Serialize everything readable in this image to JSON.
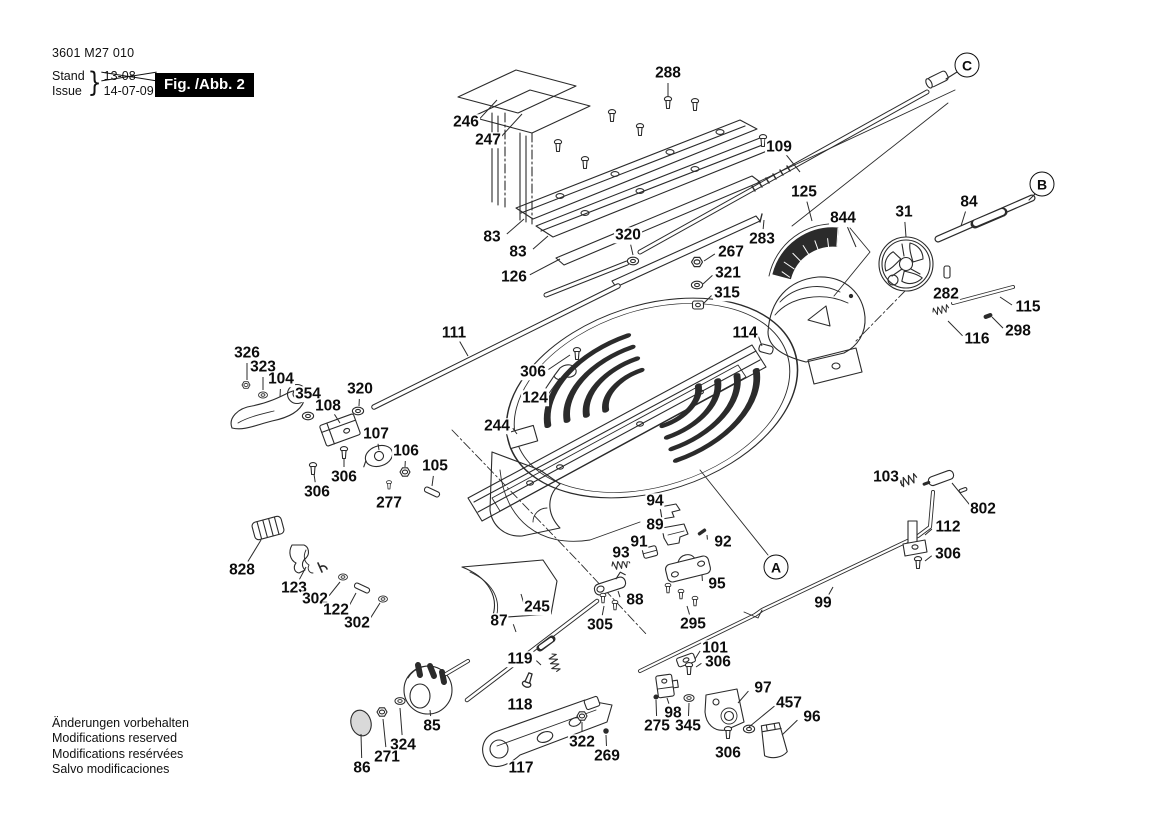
{
  "header": {
    "part_number": "3601 M27 010",
    "stand_label": "Stand",
    "issue_label": "Issue",
    "stand_value": "13-08",
    "issue_value": "14-07-09",
    "figure_label": "Fig. /Abb. 2"
  },
  "footer": {
    "notes": [
      "Änderungen vorbehalten",
      "Modifications reserved",
      "Modifications resérvées",
      "Salvo modificaciones"
    ]
  },
  "colors": {
    "ink": "#0d0d0d",
    "figbox_bg": "#000000",
    "figbox_text": "#ffffff"
  },
  "reference_bubbles": [
    {
      "label": "A",
      "x": 776,
      "y": 567
    },
    {
      "label": "B",
      "x": 1042,
      "y": 184
    },
    {
      "label": "C",
      "x": 967,
      "y": 65
    }
  ],
  "callouts": [
    {
      "label": "288",
      "x": 668,
      "y": 73,
      "tx": 668,
      "ty": 96
    },
    {
      "label": "246",
      "x": 466,
      "y": 122,
      "tx": 497,
      "ty": 100
    },
    {
      "label": "247",
      "x": 488,
      "y": 140,
      "tx": 522,
      "ty": 114
    },
    {
      "label": "109",
      "x": 779,
      "y": 147,
      "tx": 800,
      "ty": 172
    },
    {
      "label": "83",
      "x": 492,
      "y": 237,
      "tx": 524,
      "ty": 219
    },
    {
      "label": "83",
      "x": 518,
      "y": 252,
      "tx": 548,
      "ty": 236
    },
    {
      "label": "126",
      "x": 514,
      "y": 277,
      "tx": 560,
      "ty": 259
    },
    {
      "label": "320",
      "x": 628,
      "y": 235,
      "tx": 633,
      "ty": 255
    },
    {
      "label": "125",
      "x": 804,
      "y": 192,
      "tx": 812,
      "ty": 221
    },
    {
      "label": "844",
      "x": 843,
      "y": 218,
      "tx": 856,
      "ty": 247
    },
    {
      "label": "283",
      "x": 762,
      "y": 239,
      "tx": 764,
      "ty": 220
    },
    {
      "label": "267",
      "x": 731,
      "y": 252,
      "tx": 704,
      "ty": 261
    },
    {
      "label": "321",
      "x": 728,
      "y": 273,
      "tx": 703,
      "ty": 284
    },
    {
      "label": "315",
      "x": 727,
      "y": 293,
      "tx": 703,
      "ty": 304
    },
    {
      "label": "31",
      "x": 904,
      "y": 212,
      "tx": 906,
      "ty": 237
    },
    {
      "label": "84",
      "x": 969,
      "y": 202,
      "tx": 961,
      "ty": 226
    },
    {
      "label": "282",
      "x": 946,
      "y": 294,
      "tx": 947,
      "ty": 280
    },
    {
      "label": "115",
      "x": 1028,
      "y": 307,
      "tx": 1000,
      "ty": 297
    },
    {
      "label": "298",
      "x": 1018,
      "y": 331,
      "tx": 992,
      "ty": 317
    },
    {
      "label": "116",
      "x": 977,
      "y": 339,
      "tx": 948,
      "ty": 321
    },
    {
      "label": "114",
      "x": 745,
      "y": 333,
      "tx": 762,
      "ty": 346
    },
    {
      "label": "111",
      "x": 454,
      "y": 333,
      "tx": 468,
      "ty": 356
    },
    {
      "label": "326",
      "x": 247,
      "y": 353,
      "tx": 247,
      "ty": 380
    },
    {
      "label": "323",
      "x": 263,
      "y": 367,
      "tx": 263,
      "ty": 390
    },
    {
      "label": "104",
      "x": 281,
      "y": 379,
      "tx": 280,
      "ty": 397
    },
    {
      "label": "354",
      "x": 308,
      "y": 394,
      "tx": 308,
      "ty": 410
    },
    {
      "label": "108",
      "x": 328,
      "y": 406,
      "tx": 340,
      "ty": 423
    },
    {
      "label": "320",
      "x": 360,
      "y": 389,
      "tx": 359,
      "ty": 406
    },
    {
      "label": "107",
      "x": 376,
      "y": 434,
      "tx": 379,
      "ty": 450
    },
    {
      "label": "106",
      "x": 406,
      "y": 451,
      "tx": 405,
      "ty": 467
    },
    {
      "label": "105",
      "x": 435,
      "y": 466,
      "tx": 432,
      "ty": 486
    },
    {
      "label": "306",
      "x": 533,
      "y": 372,
      "tx": 570,
      "ty": 355
    },
    {
      "label": "124",
      "x": 535,
      "y": 398,
      "tx": 560,
      "ty": 378
    },
    {
      "label": "244",
      "x": 497,
      "y": 426,
      "tx": 517,
      "ty": 434
    },
    {
      "label": "306",
      "x": 344,
      "y": 477,
      "tx": 344,
      "ty": 459
    },
    {
      "label": "306",
      "x": 317,
      "y": 492,
      "tx": 314,
      "ty": 474
    },
    {
      "label": "277",
      "x": 389,
      "y": 503,
      "tx": 389,
      "ty": 490
    },
    {
      "label": "828",
      "x": 242,
      "y": 570,
      "tx": 261,
      "ty": 540
    },
    {
      "label": "123",
      "x": 294,
      "y": 588,
      "tx": 306,
      "ty": 567
    },
    {
      "label": "302",
      "x": 315,
      "y": 599,
      "tx": 340,
      "ty": 582
    },
    {
      "label": "122",
      "x": 336,
      "y": 610,
      "tx": 356,
      "ty": 593
    },
    {
      "label": "302",
      "x": 357,
      "y": 623,
      "tx": 380,
      "ty": 603
    },
    {
      "label": "87",
      "x": 499,
      "y": 621,
      "tx": 516,
      "ty": 632
    },
    {
      "label": "245",
      "x": 537,
      "y": 607,
      "tx": 521,
      "ty": 594
    },
    {
      "label": "94",
      "x": 655,
      "y": 501,
      "tx": 667,
      "ty": 510
    },
    {
      "label": "89",
      "x": 655,
      "y": 525,
      "tx": 667,
      "ty": 532
    },
    {
      "label": "91",
      "x": 639,
      "y": 542,
      "tx": 648,
      "ty": 551
    },
    {
      "label": "93",
      "x": 621,
      "y": 553,
      "tx": 624,
      "ty": 565
    },
    {
      "label": "92",
      "x": 723,
      "y": 542,
      "tx": 707,
      "ty": 535
    },
    {
      "label": "95",
      "x": 717,
      "y": 584,
      "tx": 702,
      "ty": 575
    },
    {
      "label": "88",
      "x": 635,
      "y": 600,
      "tx": 618,
      "ty": 591
    },
    {
      "label": "305",
      "x": 600,
      "y": 625,
      "tx": 604,
      "ty": 606
    },
    {
      "label": "295",
      "x": 693,
      "y": 624,
      "tx": 687,
      "ty": 606
    },
    {
      "label": "103",
      "x": 886,
      "y": 477,
      "tx": 902,
      "ty": 486
    },
    {
      "label": "802",
      "x": 983,
      "y": 509,
      "tx": 952,
      "ty": 483
    },
    {
      "label": "112",
      "x": 948,
      "y": 527,
      "tx": 925,
      "ty": 535
    },
    {
      "label": "306",
      "x": 948,
      "y": 554,
      "tx": 925,
      "ty": 561
    },
    {
      "label": "99",
      "x": 823,
      "y": 603,
      "tx": 833,
      "ty": 587
    },
    {
      "label": "101",
      "x": 715,
      "y": 648,
      "tx": 695,
      "ty": 659
    },
    {
      "label": "306",
      "x": 718,
      "y": 662,
      "tx": 696,
      "ty": 667
    },
    {
      "label": "119",
      "x": 520,
      "y": 659,
      "tx": 541,
      "ty": 665
    },
    {
      "label": "118",
      "x": 520,
      "y": 705,
      "tx": 525,
      "ty": 691
    },
    {
      "label": "85",
      "x": 432,
      "y": 726,
      "tx": 430,
      "ty": 710
    },
    {
      "label": "324",
      "x": 403,
      "y": 745,
      "tx": 400,
      "ty": 708
    },
    {
      "label": "271",
      "x": 387,
      "y": 757,
      "tx": 383,
      "ty": 719
    },
    {
      "label": "86",
      "x": 362,
      "y": 768,
      "tx": 361,
      "ty": 734
    },
    {
      "label": "117",
      "x": 521,
      "y": 768,
      "tx": 525,
      "ty": 753
    },
    {
      "label": "322",
      "x": 582,
      "y": 742,
      "tx": 582,
      "ty": 722
    },
    {
      "label": "269",
      "x": 607,
      "y": 756,
      "tx": 606,
      "ty": 735
    },
    {
      "label": "98",
      "x": 673,
      "y": 713,
      "tx": 667,
      "ty": 698
    },
    {
      "label": "275",
      "x": 657,
      "y": 726,
      "tx": 656,
      "ty": 700
    },
    {
      "label": "345",
      "x": 688,
      "y": 726,
      "tx": 689,
      "ty": 703
    },
    {
      "label": "97",
      "x": 763,
      "y": 688,
      "tx": 738,
      "ty": 703
    },
    {
      "label": "457",
      "x": 789,
      "y": 703,
      "tx": 749,
      "ty": 727
    },
    {
      "label": "96",
      "x": 812,
      "y": 717,
      "tx": 782,
      "ty": 735
    },
    {
      "label": "306",
      "x": 728,
      "y": 753,
      "tx": 728,
      "ty": 740
    }
  ]
}
